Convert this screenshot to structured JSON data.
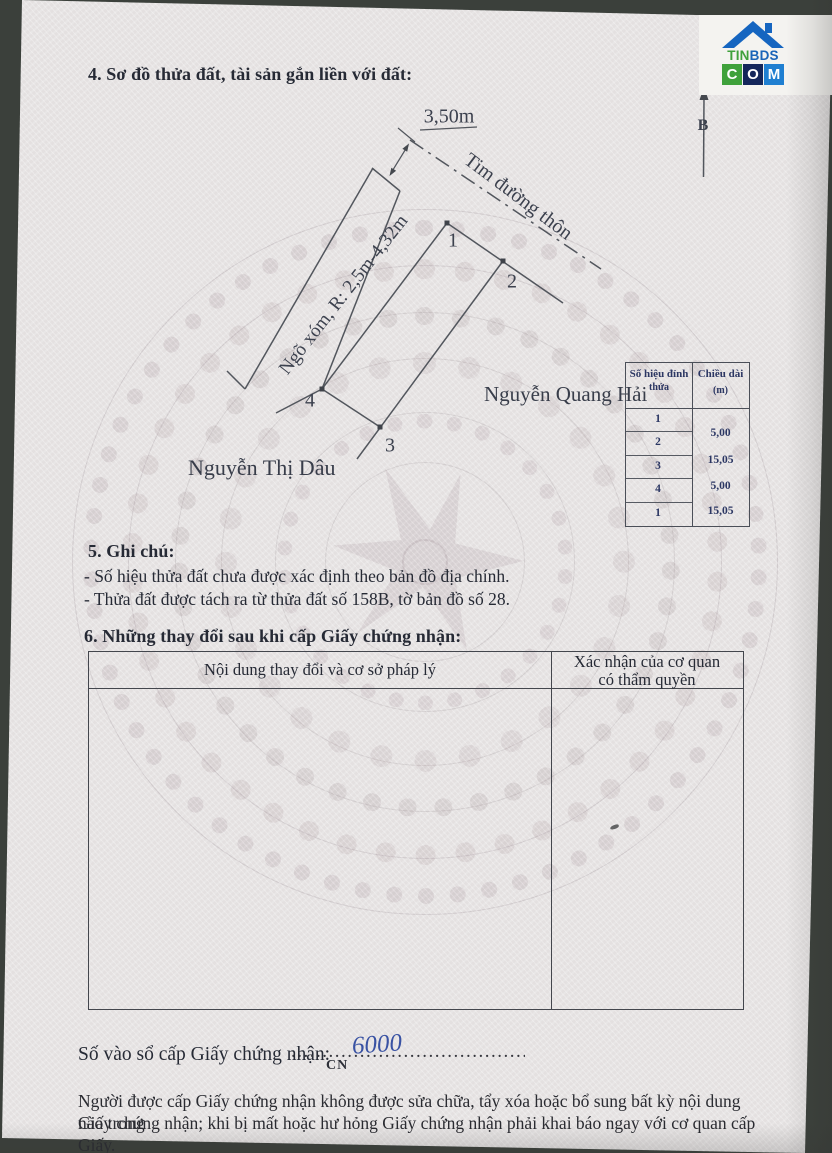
{
  "logo": {
    "word_part1": "TIN",
    "word_part2": "BDS",
    "block_letters": [
      "C",
      "O",
      "M"
    ],
    "colors": {
      "green": "#3fa13b",
      "blue": "#1f7fd1",
      "navy": "#14265a",
      "roof_blue": "#1565c0",
      "word_blue": "#1a64b8"
    }
  },
  "section4": {
    "heading": "4. Sơ đồ thửa đất, tài sản gắn liền với đất:"
  },
  "diagram": {
    "north_label": "B",
    "road_width_dim": "3,50m",
    "road_centerline_label": "Tim đường thôn",
    "alley_label": "Ngõ xóm, R: 2,5m-4,32m",
    "vertex_labels": [
      "1",
      "2",
      "3",
      "4"
    ],
    "neighbor_right": "Nguyễn Quang Hải",
    "neighbor_left": "Nguyễn Thị Dâu"
  },
  "vertex_table": {
    "header_col1_line1": "Số hiệu đỉnh",
    "header_col1_line2": "thửa",
    "header_col2_line1": "Chiều dài",
    "header_col2_line2": "(m)",
    "vertices": [
      "1",
      "2",
      "3",
      "4",
      "1"
    ],
    "lengths": [
      "5,00",
      "15,05",
      "5,00",
      "15,05"
    ]
  },
  "section5": {
    "heading": "5. Ghi chú:",
    "notes": [
      "- Số hiệu thửa đất chưa được xác định theo bản đồ địa chính.",
      "- Thửa đất được tách ra từ thửa đất số 158B, tờ bản đồ số 28."
    ]
  },
  "section6": {
    "heading": "6. Những thay đổi sau khi cấp Giấy chứng nhận:",
    "col1_header": "Nội dung thay đổi và cơ sở pháp lý",
    "col2_header_line1": "Xác nhận của cơ quan",
    "col2_header_line2": "có thẩm quyền"
  },
  "footer": {
    "register_label": "Số vào sổ cấp Giấy chứng nhận:",
    "register_prefix": "CN",
    "register_value_handwritten": "6000",
    "dots": "......................................................",
    "ink_color": "#3952a3",
    "notice_line1": "Người được cấp Giấy chứng nhận không được sửa chữa, tẩy xóa hoặc bổ sung bất kỳ nội dung nào trong",
    "notice_line2": "Giấy chứng nhận; khi bị mất hoặc hư hỏng Giấy chứng nhận phải khai báo ngay với cơ quan cấp Giấy."
  }
}
